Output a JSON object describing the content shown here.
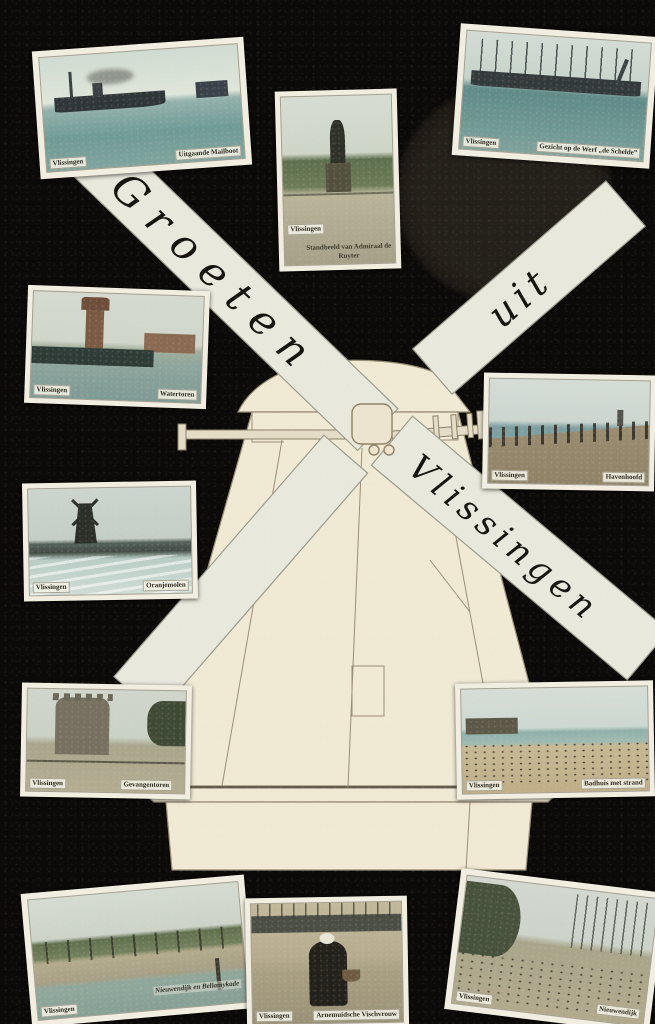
{
  "postcard": {
    "greeting": "Groeten uit Vlissingen",
    "colors": {
      "background": "#0c0a08",
      "mill_paper": "#f0e9d4",
      "sail_paper": "#e8e8dc",
      "photo_border": "#f1eee1"
    }
  },
  "sails": {
    "groeten": "Groeten",
    "uit": "uit",
    "vlissingen": "Vlissingen"
  },
  "photos": [
    {
      "place": "Vlissingen",
      "caption": "Uitgaande Mailboot"
    },
    {
      "place": "Vlissingen",
      "caption": "Gezicht op de Werf „de Schelde”"
    },
    {
      "place": "Vlissingen",
      "caption": "Standbeeld van Admiraal de Ruyter"
    },
    {
      "place": "Vlissingen",
      "caption": "Watertoren"
    },
    {
      "place": "Vlissingen",
      "caption": "Havenhoofd"
    },
    {
      "place": "Vlissingen",
      "caption": "Oranjemolen"
    },
    {
      "place": "Vlissingen",
      "caption": "Gevangentoren"
    },
    {
      "place": "Vlissingen",
      "caption": "Badhuis met strand"
    },
    {
      "place": "Vlissingen",
      "caption": "Nieuwendijk en Bellamykade"
    },
    {
      "place": "Vlissingen",
      "caption": "Arnemuidsche Vischvrouw"
    },
    {
      "place": "Vlissingen",
      "caption": "Nieuwendijk"
    }
  ]
}
